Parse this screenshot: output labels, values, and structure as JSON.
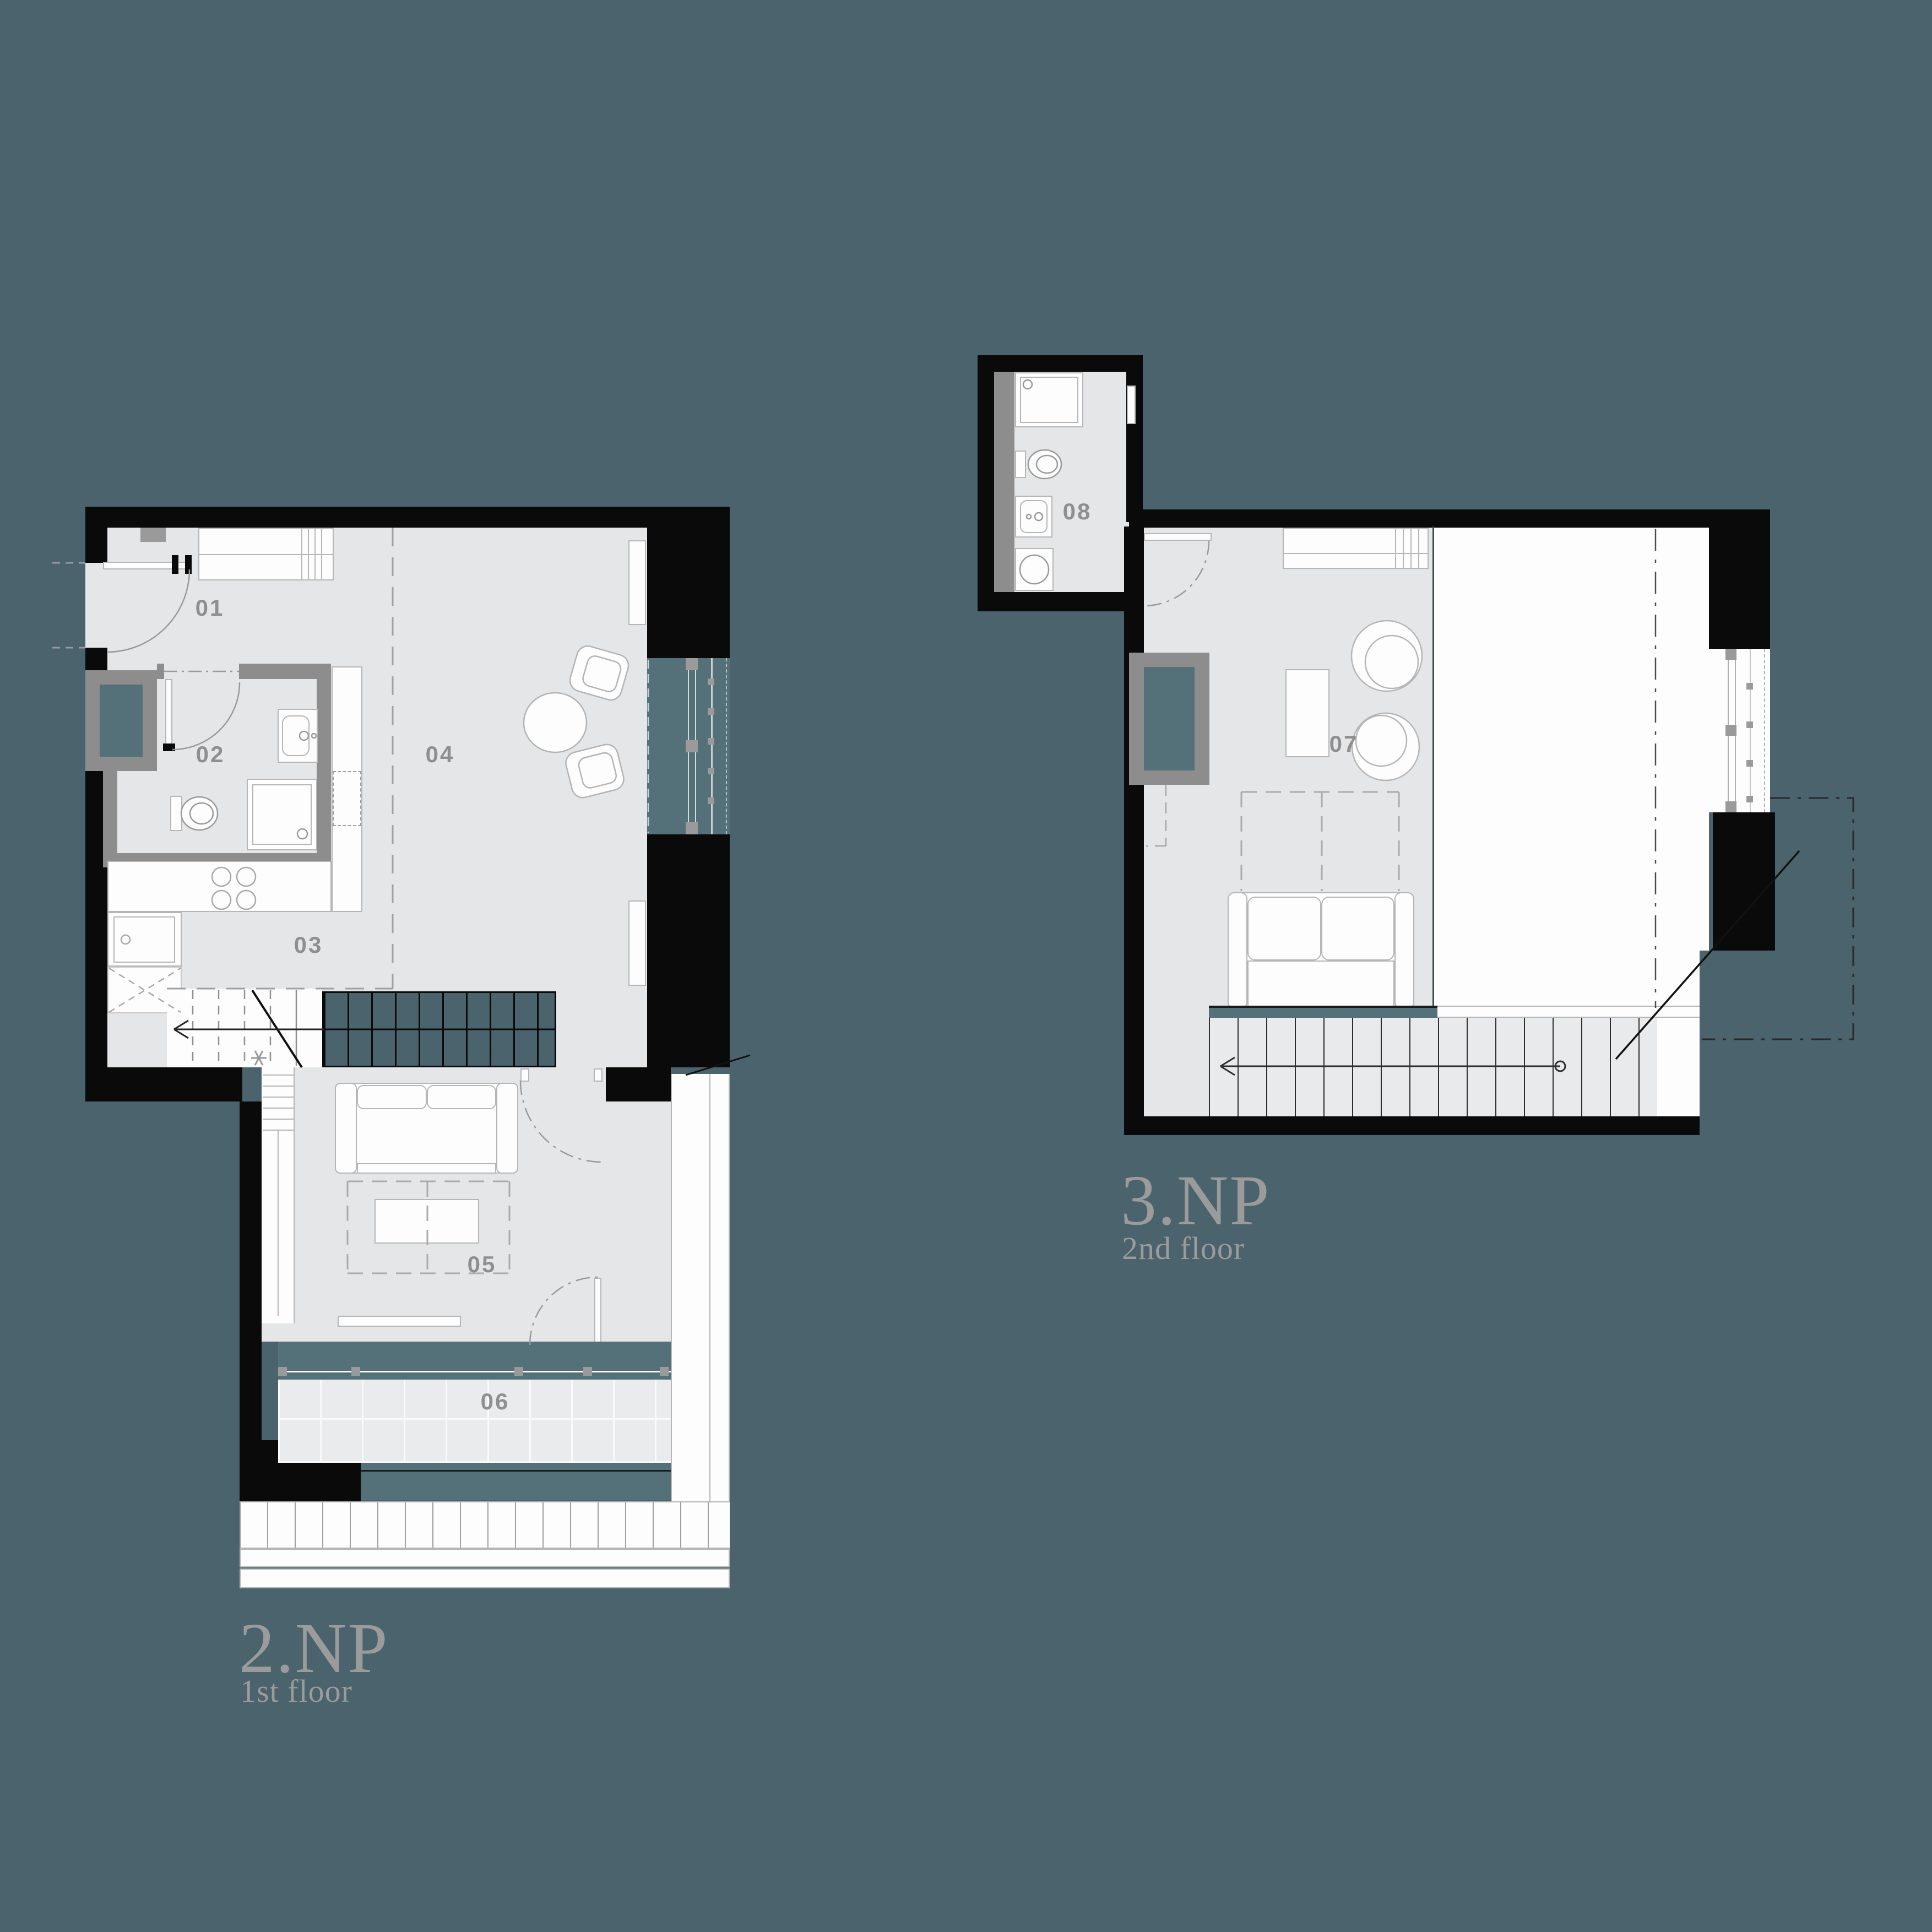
{
  "document": {
    "type": "architectural-floor-plan",
    "background_color": "#4a636c",
    "wall_color": "#0a0a0a",
    "partition_wall_color": "#8d8d8d",
    "floor_color": "#e4e6e7",
    "glass_color": "#547079",
    "furniture_stroke_color": "#b6b6b6",
    "room_label_color": "#8f8f8f",
    "title_color": "#9b9b9b"
  },
  "plans": {
    "first": {
      "title": "2.NP",
      "subtitle": "1st floor",
      "rooms": {
        "r01": "01",
        "r02": "02",
        "r03": "03",
        "r04": "04",
        "r05": "05",
        "r06": "06"
      }
    },
    "second": {
      "title": "3.NP",
      "subtitle": "2nd floor",
      "rooms": {
        "r07": "07",
        "r08": "08"
      }
    }
  }
}
